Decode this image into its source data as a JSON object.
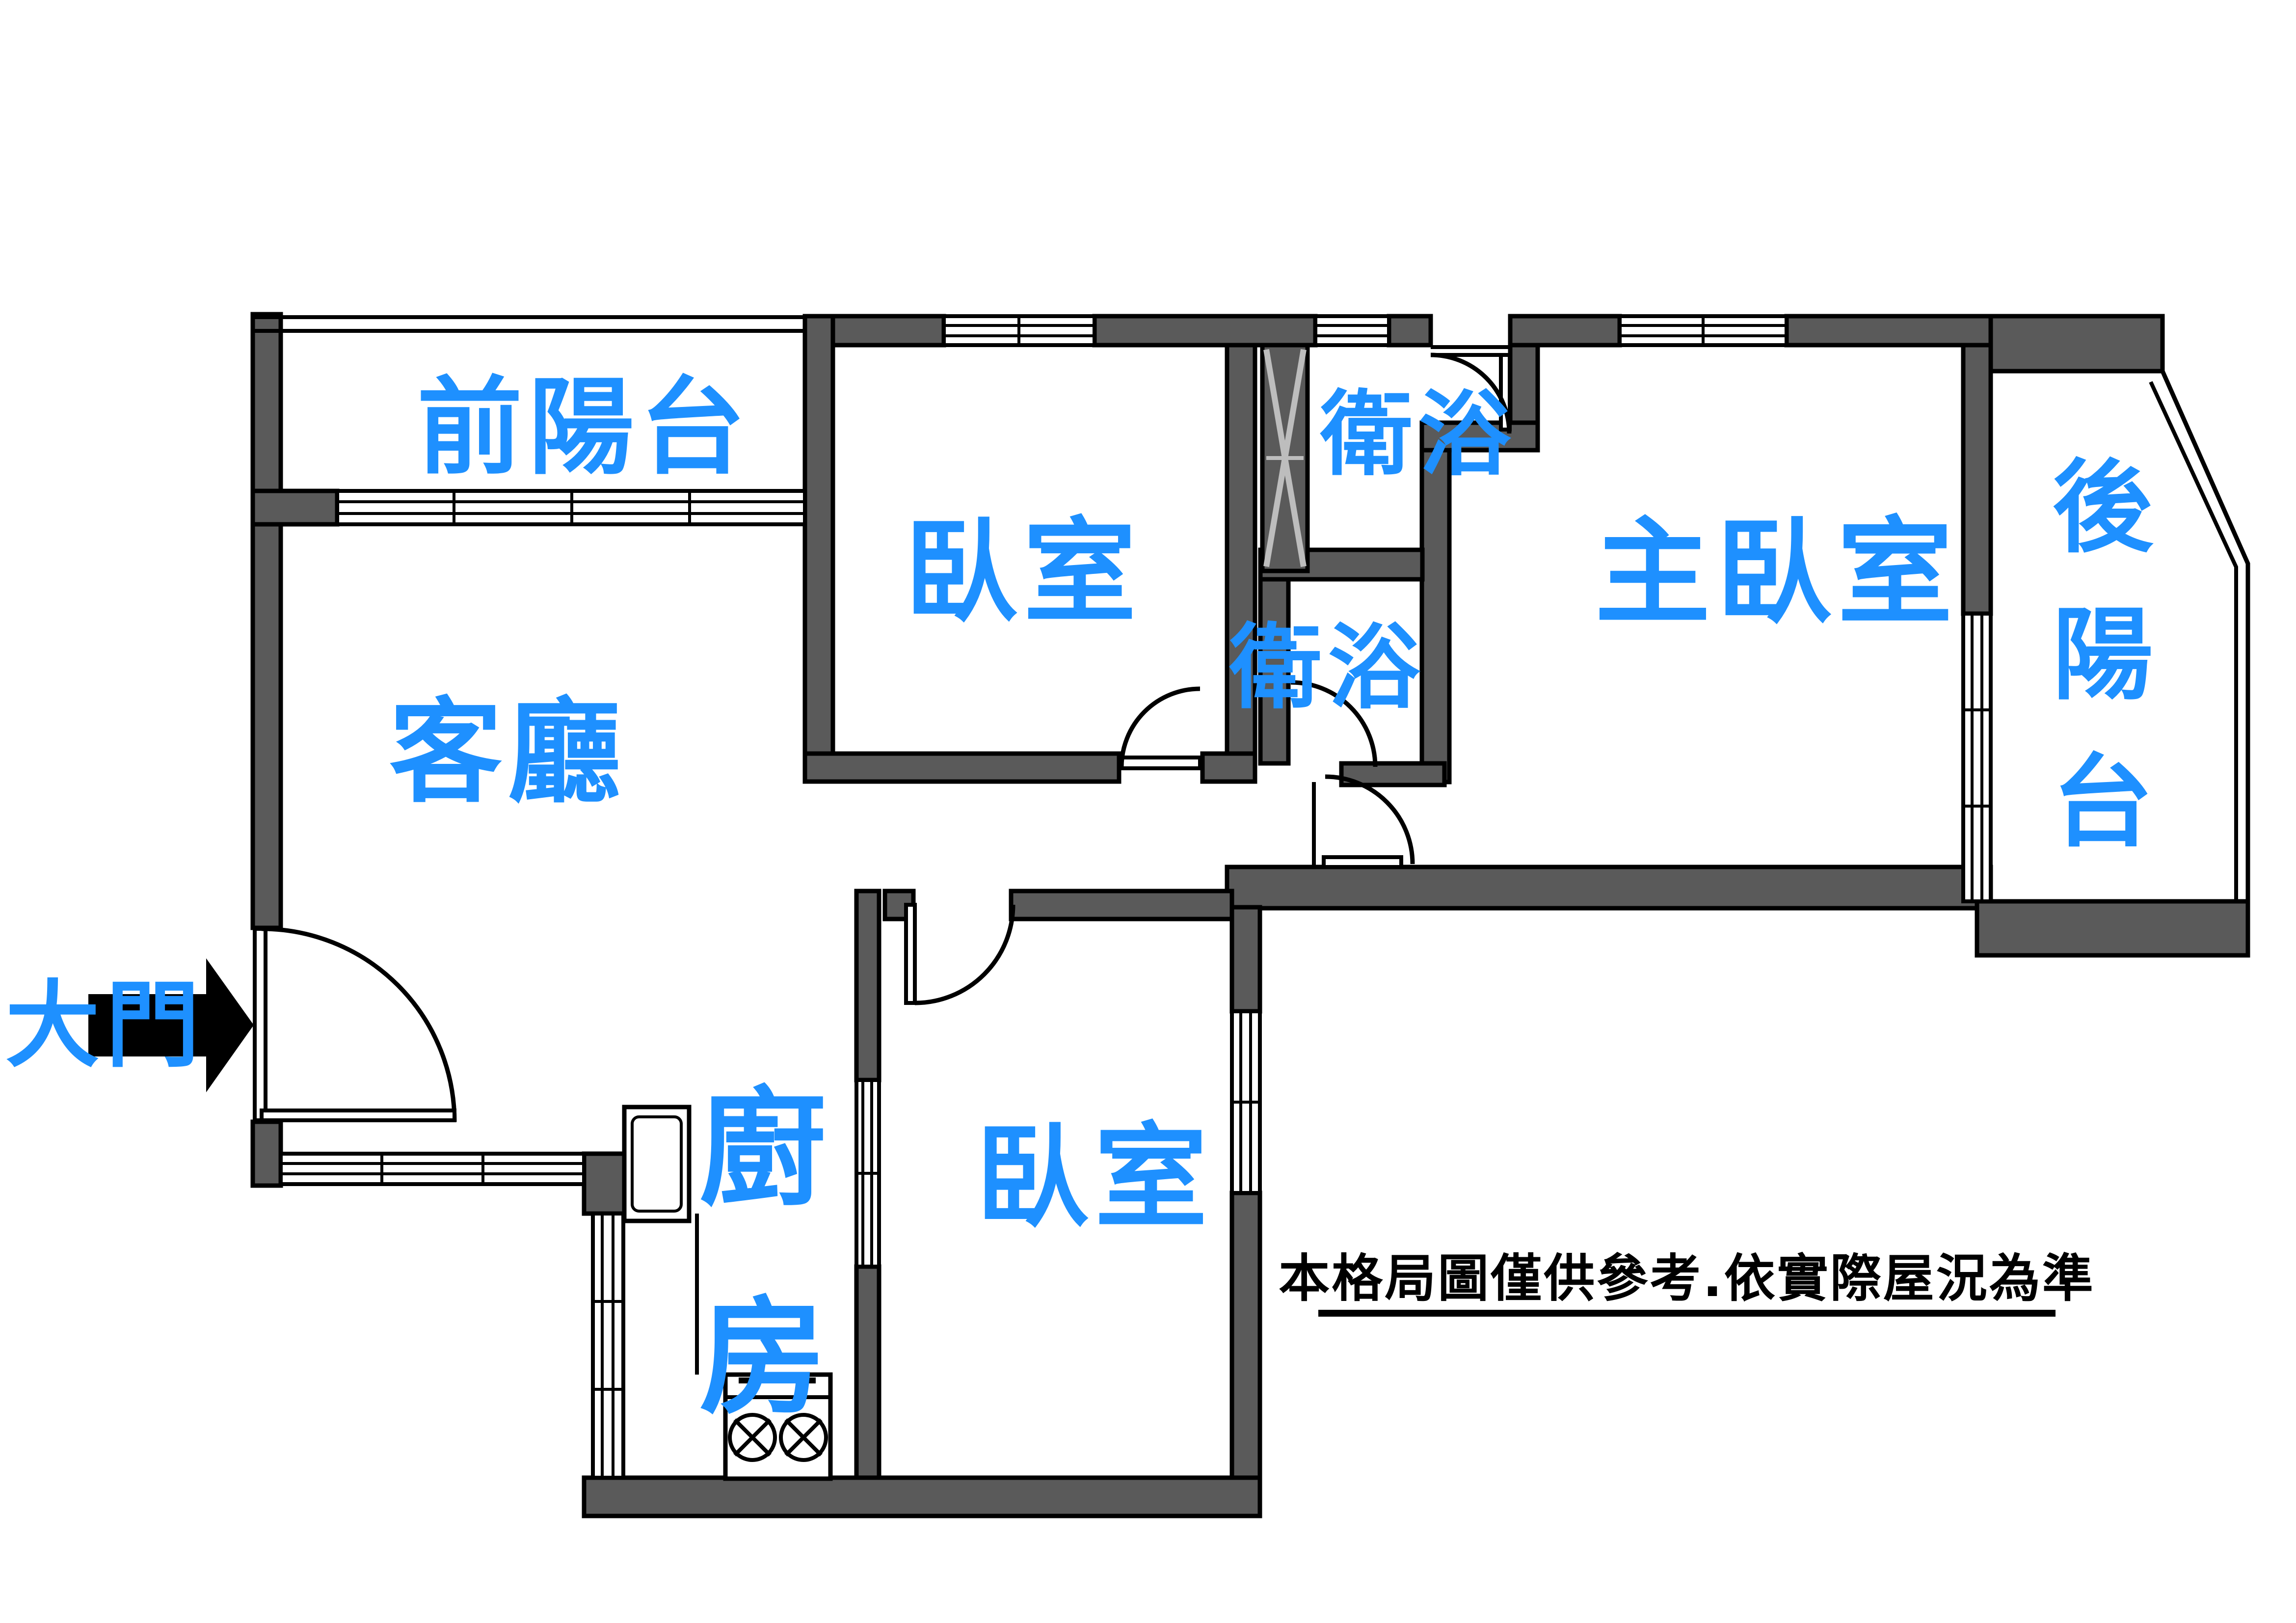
{
  "title": "apartment-floor-plan",
  "colors": {
    "label_blue": "#1E90FF",
    "wall_gray": "#5A5A5A",
    "line_black": "#000000",
    "background": "#FFFFFF"
  },
  "rooms": {
    "front_balcony": {
      "label": "前陽台"
    },
    "living_room": {
      "label": "客廳"
    },
    "bedroom_top": {
      "label": "臥室"
    },
    "bath_upper": {
      "label": "衛浴"
    },
    "bath_lower": {
      "label": "衛浴"
    },
    "master_bedroom": {
      "label": "主臥室"
    },
    "back_balcony": {
      "label": "後陽台",
      "chars": [
        "後",
        "陽",
        "台"
      ]
    },
    "kitchen": {
      "label": "廚房",
      "chars": [
        "廚",
        "房"
      ]
    },
    "bedroom_bottom": {
      "label": "臥室"
    }
  },
  "entrance": {
    "label": "大門",
    "icon": "right-arrow"
  },
  "symbols": {
    "shaft": "pipe-duct-shaft",
    "stove_burners": 2
  },
  "disclaimer": {
    "text": "本格局圖僅供參考.依實際屋況為準"
  }
}
